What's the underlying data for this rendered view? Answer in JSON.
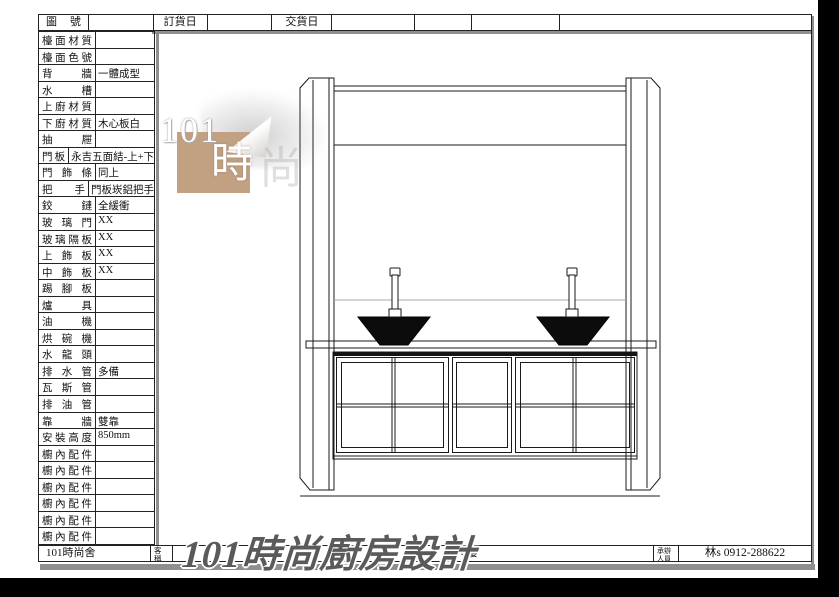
{
  "header": {
    "cells": [
      "圖號",
      "",
      "訂貨日",
      "",
      "交貨日",
      "",
      "",
      "",
      ""
    ]
  },
  "spec_table": {
    "rows": [
      {
        "label": "檯面材質",
        "value": ""
      },
      {
        "label": "檯面色號",
        "value": ""
      },
      {
        "label": "背牆",
        "value": "一體成型"
      },
      {
        "label": "水槽",
        "value": ""
      },
      {
        "label": "上廚材質",
        "value": ""
      },
      {
        "label": "下廚材質",
        "value": "木心板白"
      },
      {
        "label": "抽屜",
        "value": ""
      },
      {
        "label": "門板",
        "value": "永吉五面結-上+下"
      },
      {
        "label": "門飾條",
        "value": "同上"
      },
      {
        "label": "把手",
        "value": "門板崁鋁把手"
      },
      {
        "label": "鉸鏈",
        "value": "全緩衝"
      },
      {
        "label": "玻璃門",
        "value": "XX"
      },
      {
        "label": "玻璃隔板",
        "value": "XX"
      },
      {
        "label": "上飾板",
        "value": "XX"
      },
      {
        "label": "中飾板",
        "value": "XX"
      },
      {
        "label": "踢腳板",
        "value": ""
      },
      {
        "label": "爐具",
        "value": ""
      },
      {
        "label": "油機",
        "value": ""
      },
      {
        "label": "烘碗機",
        "value": ""
      },
      {
        "label": "水龍頭",
        "value": ""
      },
      {
        "label": "排水管",
        "value": "多備"
      },
      {
        "label": "瓦斯管",
        "value": ""
      },
      {
        "label": "排油管",
        "value": ""
      },
      {
        "label": "靠牆",
        "value": "雙靠"
      },
      {
        "label": "安裝高度",
        "value": "850mm"
      },
      {
        "label": "櫥內配件",
        "value": ""
      },
      {
        "label": "櫥內配件",
        "value": ""
      },
      {
        "label": "櫥內配件",
        "value": ""
      },
      {
        "label": "櫥內配件",
        "value": ""
      },
      {
        "label": "櫥內配件",
        "value": ""
      },
      {
        "label": "櫥內配件",
        "value": ""
      }
    ]
  },
  "footer": {
    "company": "101時尚舍",
    "client_label": "客稱",
    "client_value": "4樓",
    "handler_label": "承辦人員",
    "contact": "林s 0912-288622"
  },
  "watermark": {
    "logo_number": "101",
    "logo_char": "時",
    "ghost_char": "尚",
    "title": "101時尚廚房設計"
  },
  "colors": {
    "background": "#000000",
    "paper": "#ffffff",
    "line": "#1a1a1a",
    "bevel_gray": "#8f8f8f",
    "stamp_tan": "#c2a183",
    "sink_black": "#0c0c0c",
    "watermark_gray": "#5a5a5a"
  }
}
